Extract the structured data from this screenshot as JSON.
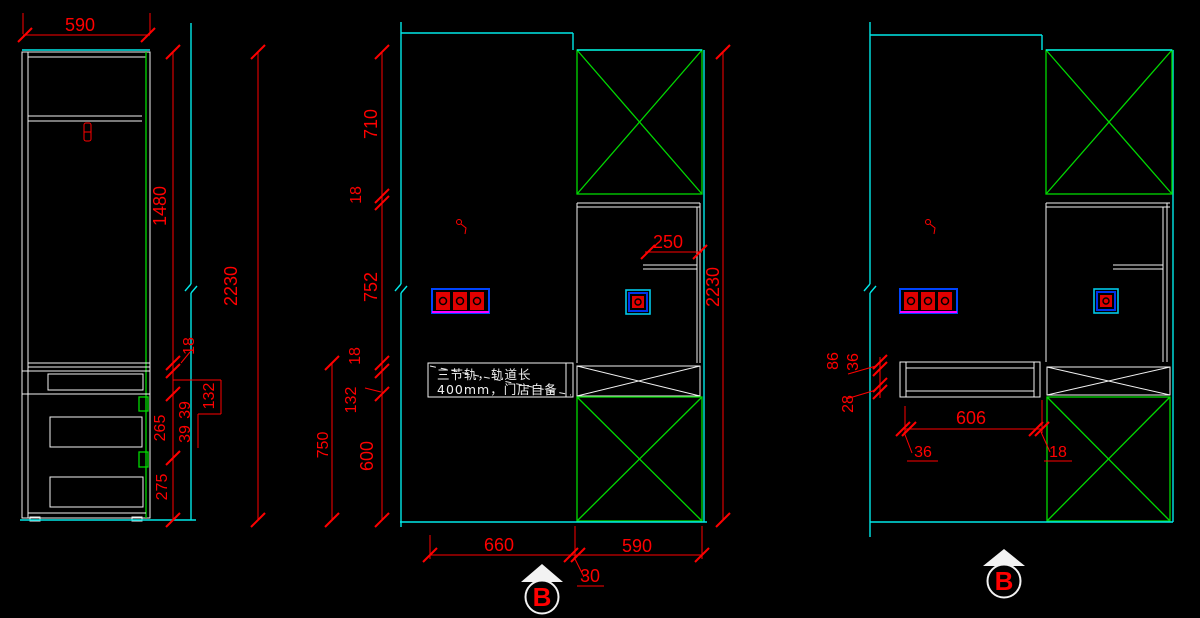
{
  "drawing": {
    "background": "#000000",
    "colors": {
      "line_white": "#f2f2f2",
      "wall_cyan": "#00e8e8",
      "panel_green": "#00d900",
      "dimension_red": "#ff0000",
      "socket_blue": "#0033ff",
      "socket_magenta": "#ff00ff"
    }
  },
  "left_view": {
    "width_top": "590",
    "height_upper": "1480",
    "height_total": "2230",
    "gap_18": "18",
    "drawer_132": "132",
    "gap_39a": "39",
    "gap_39b": "39",
    "drawer_265": "265",
    "drawer_275": "275"
  },
  "middle_view": {
    "h_710": "710",
    "h_18_upper": "18",
    "h_752": "752",
    "h_18_lower": "18",
    "h_132": "132",
    "h_600": "600",
    "h_750": "750",
    "shelf_250": "250",
    "height_total": "2230",
    "w_660": "660",
    "w_30": "30",
    "w_590": "590",
    "annotation_line1": "三节轨，轨道长",
    "annotation_line2": "400mm，门店自备",
    "section_label": "B"
  },
  "right_view": {
    "h_86": "86",
    "h_36": "36",
    "h_28": "28",
    "w_606": "606",
    "w_36": "36",
    "w_18": "18",
    "section_label": "B"
  }
}
